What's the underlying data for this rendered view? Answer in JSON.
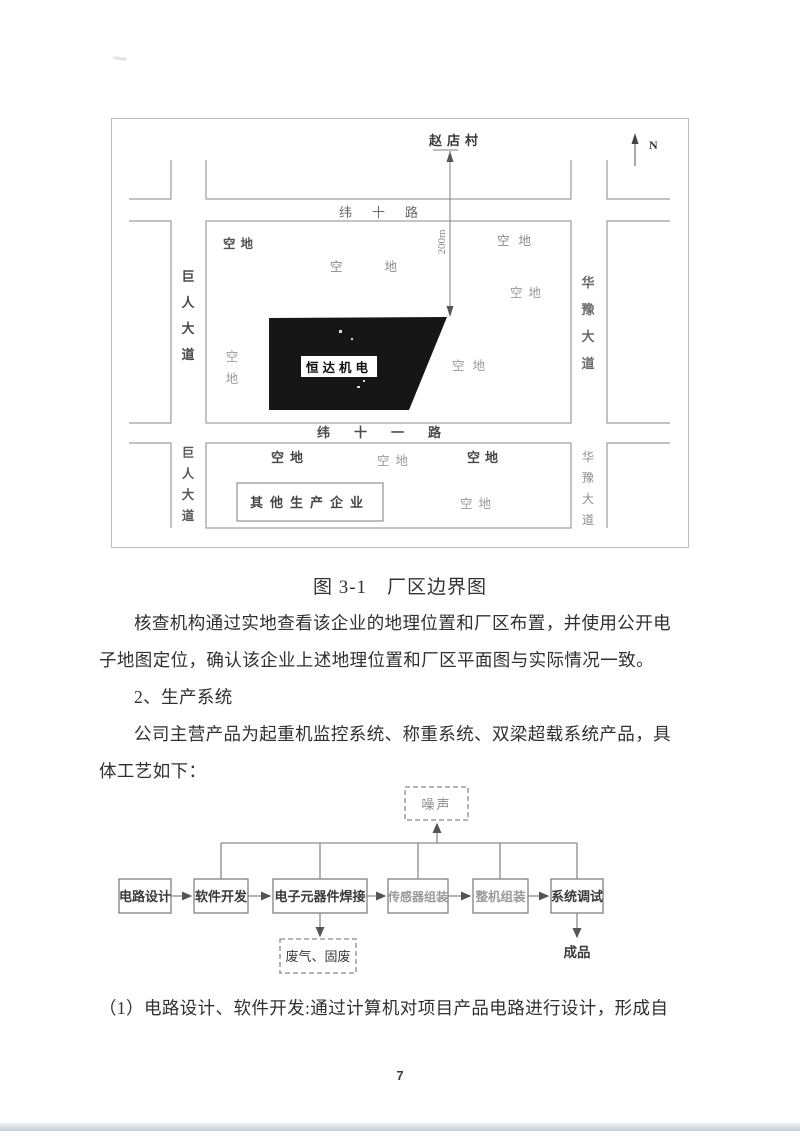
{
  "figure_map": {
    "village_top": "赵店村",
    "north": "N",
    "distance": "200m",
    "road_top": "纬十路",
    "road_middle": "纬十一路",
    "road_left": "巨人大道",
    "road_right": "华豫大道",
    "factory_label": "恒达机电",
    "other_enterprise": "其他生产企业",
    "vacant": "空地"
  },
  "caption": "图 3-1　厂区边界图",
  "body": {
    "para1": [
      "核查机构通过实地查看该企业的地理位置和厂区布置，并使用公开电",
      "子地图定位，确认该企业上述地理位置和厂区平面图与实际情况一致。"
    ],
    "heading2": "2、生产系统",
    "para2": [
      "公司主营产品为起重机监控系统、称重系统、双梁超载系统产品，具",
      "体工艺如下："
    ],
    "para3": "（1）电路设计、软件开发:通过计算机对项目产品电路进行设计，形成自"
  },
  "flowchart": {
    "steps": [
      "电路设计",
      "软件开发",
      "电子元器件焊接",
      "传感器组装",
      "整机组装",
      "系统调试"
    ],
    "noise": "噪声",
    "waste": "废气、固废",
    "product": "成品"
  },
  "page_number": "7",
  "colors": {
    "map_line": "#9d9d9d",
    "factory_fill": "#161616",
    "flow_line": "#8a8a8a"
  }
}
